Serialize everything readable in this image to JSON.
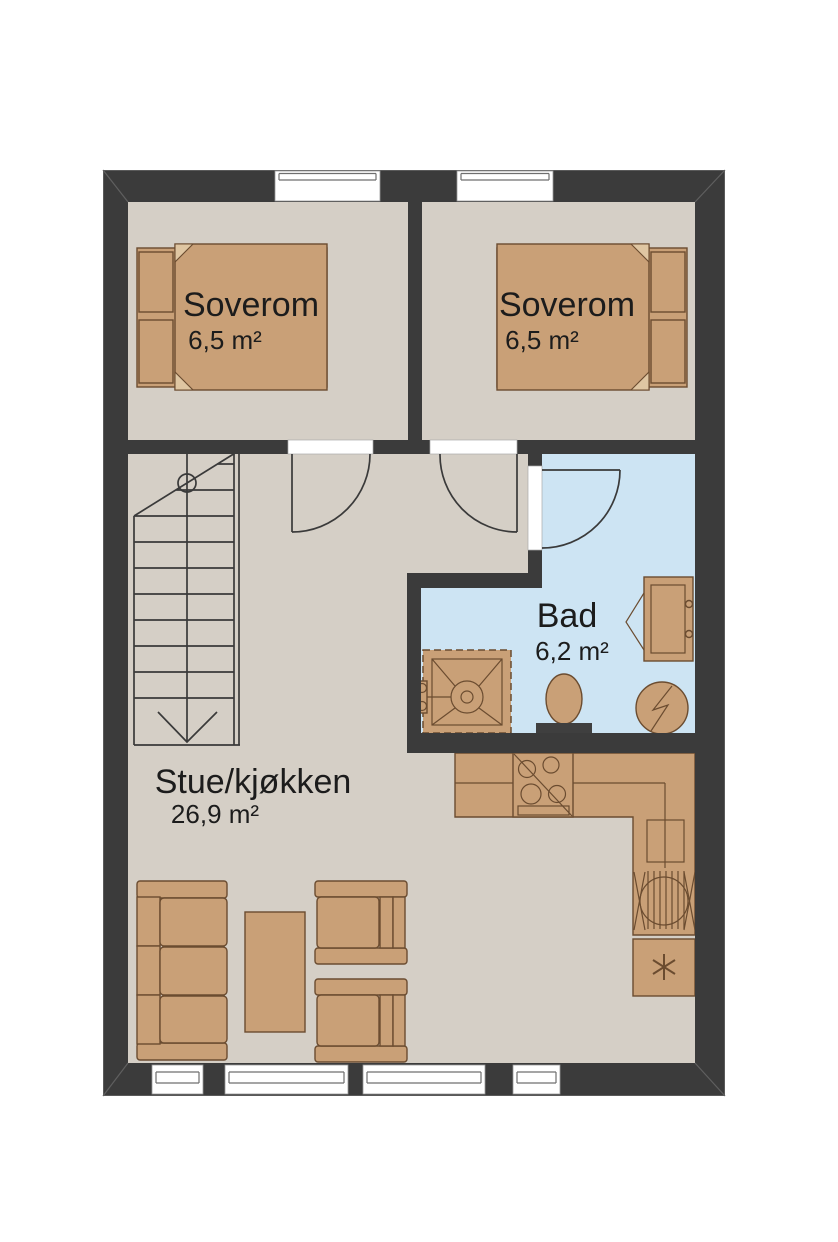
{
  "title": "Floor plan",
  "colors": {
    "wall": "#3b3b3b",
    "wall_bevel": "#5f5f5f",
    "floor": "#d5cfc6",
    "bath_floor": "#cde4f3",
    "furniture": "#c9a077",
    "furniture_outline": "#6b4c30",
    "duvet_fold": "#dfc6a2",
    "fixture_dark": "#3f3f3f",
    "line": "#3a3a3a",
    "window": "#ffffff",
    "text": "#1c1c1c"
  },
  "rooms": {
    "bedroom1": {
      "name": "Soverom",
      "area": "6,5 m²"
    },
    "bedroom2": {
      "name": "Soverom",
      "area": "6,5 m²"
    },
    "bathroom": {
      "name": "Bad",
      "area": "6,2 m²"
    },
    "living": {
      "name": "Stue/kjøkken",
      "area": "26,9 m²"
    }
  }
}
